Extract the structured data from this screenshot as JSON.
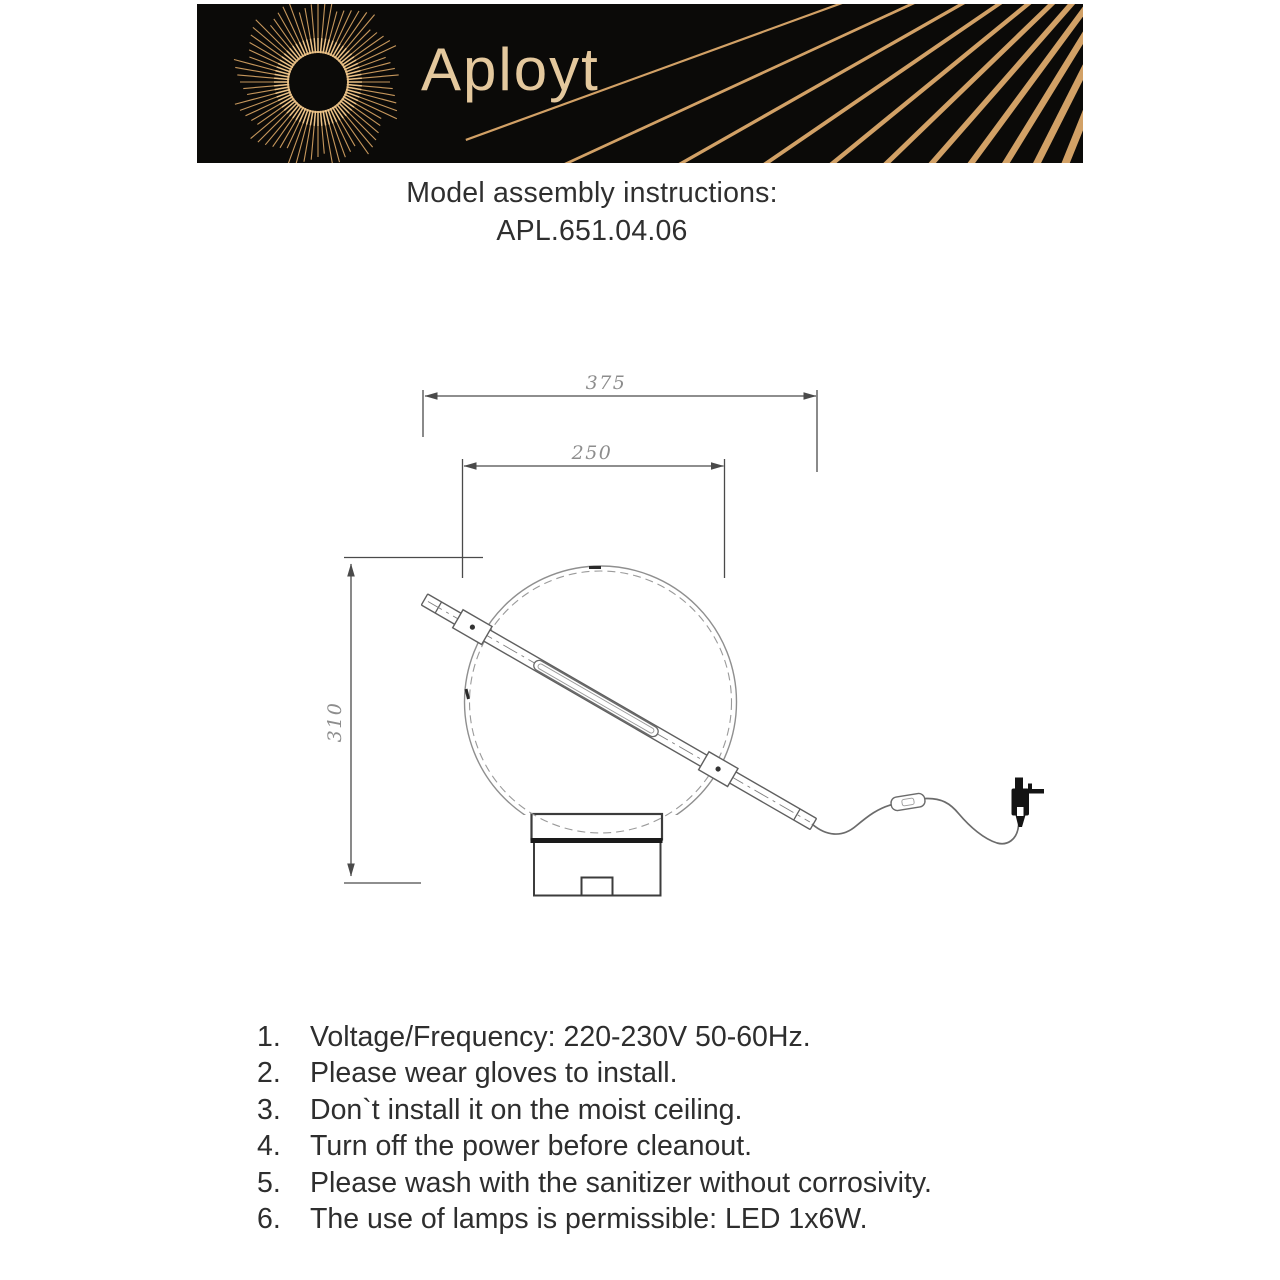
{
  "banner": {
    "brand_name": "Aployt",
    "bg_color": "#0b0a08",
    "gold_ray_color": "#c6975c",
    "gold_stripe_color": "#d2a166",
    "brand_text_color": "#e4c89d"
  },
  "title": {
    "line1": "Model assembly instructions:",
    "line2": "APL.651.04.06"
  },
  "diagram": {
    "dim_total_width": "375",
    "dim_tube_width": "250",
    "dim_height": "310"
  },
  "instructions": [
    {
      "num": "1.",
      "text": "Voltage/Frequency: 220-230V 50-60Hz."
    },
    {
      "num": "2.",
      "text": "Please wear gloves to install."
    },
    {
      "num": "3.",
      "text": "Don`t install it on the moist ceiling."
    },
    {
      "num": "4.",
      "text": "Turn off the power before cleanout."
    },
    {
      "num": "5.",
      "text": "Please wash with the sanitizer without corrosivity."
    },
    {
      "num": "6.",
      "text": "The use of lamps is permissible: LED 1x6W."
    }
  ]
}
